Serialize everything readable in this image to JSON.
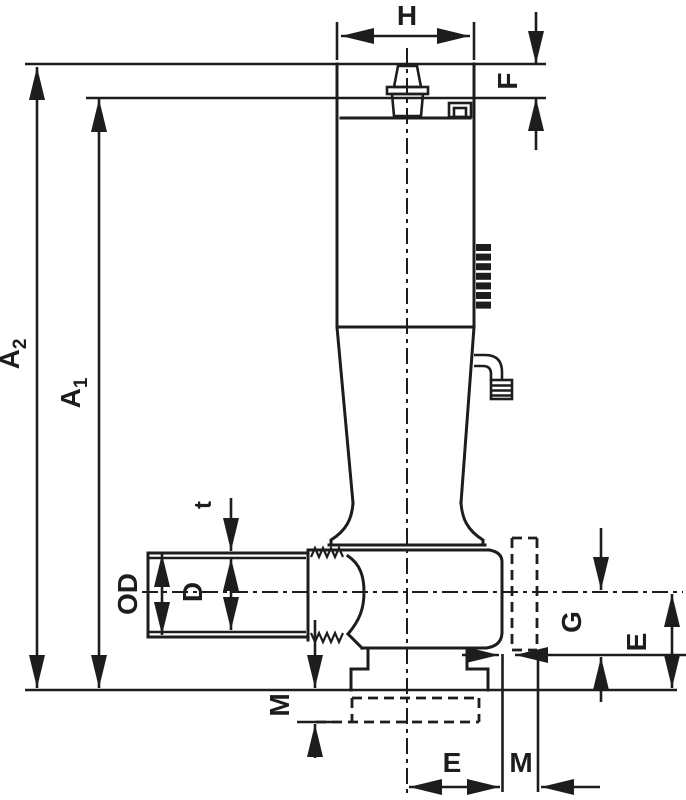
{
  "drawing": {
    "type": "valve-dimension-drawing",
    "line_color": "#1d1d1b",
    "background_color": "#ffffff",
    "dimensions": {
      "H": "H",
      "F": "F",
      "A2_base": "A",
      "A2_sub": "2",
      "A1_base": "A",
      "A1_sub": "1",
      "t": "t",
      "OD": "OD",
      "D": "D",
      "M_left": "M",
      "G": "G",
      "E_right": "E",
      "E_bottom": "E",
      "M_bottom": "M"
    }
  }
}
